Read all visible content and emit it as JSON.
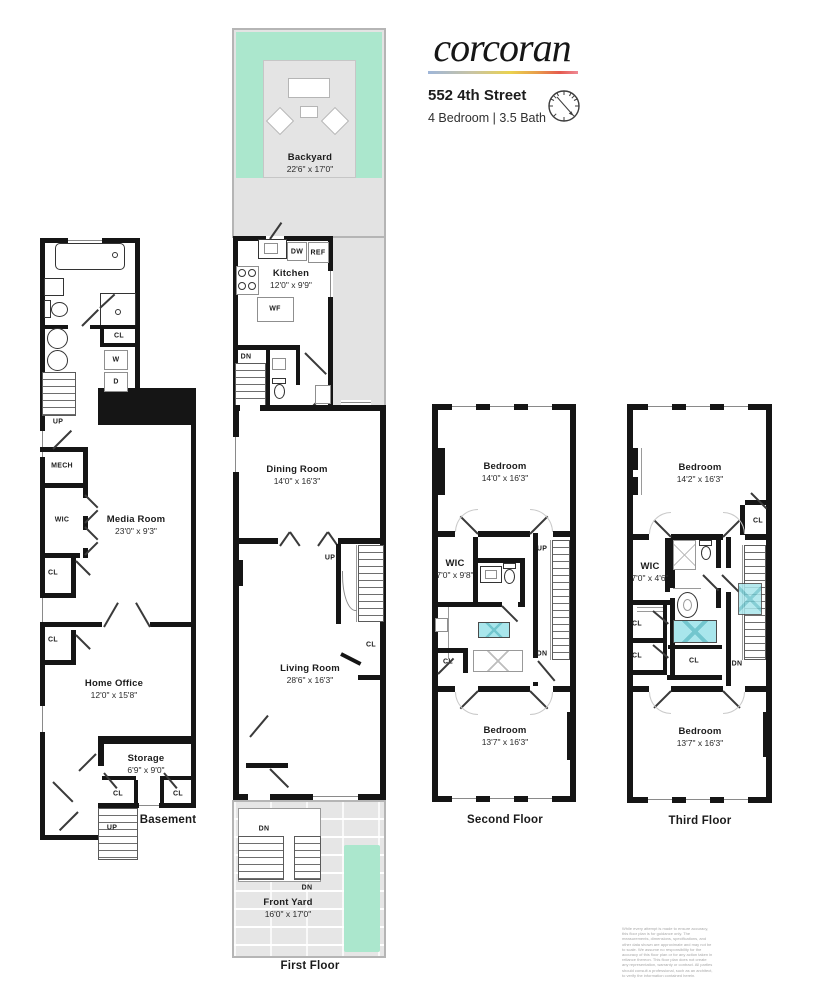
{
  "header": {
    "logo": "corcoran",
    "address": "552 4th Street",
    "specs": "4 Bedroom | 3.5 Bath"
  },
  "floor_labels": {
    "basement": "Basement",
    "first": "First Floor",
    "second": "Second Floor",
    "third": "Third Floor"
  },
  "rooms": {
    "backyard": {
      "name": "Backyard",
      "dims": "22'6\" x 17'0\""
    },
    "kitchen": {
      "name": "Kitchen",
      "dims": "12'0\" x 9'9\""
    },
    "dining": {
      "name": "Dining Room",
      "dims": "14'0\" x 16'3\""
    },
    "living": {
      "name": "Living Room",
      "dims": "28'6\" x 16'3\""
    },
    "front_yard": {
      "name": "Front Yard",
      "dims": "16'0\" x 17'0\""
    },
    "media": {
      "name": "Media Room",
      "dims": "23'0\" x 9'3\""
    },
    "home_office": {
      "name": "Home Office",
      "dims": "12'0\" x 15'8\""
    },
    "storage": {
      "name": "Storage",
      "dims": "6'9\" x 9'0\""
    },
    "bedroom2f": {
      "name": "Bedroom",
      "dims": "14'0\" x 16'3\""
    },
    "bedroom2b": {
      "name": "Bedroom",
      "dims": "13'7\" x 16'3\""
    },
    "bedroom3f": {
      "name": "Bedroom",
      "dims": "14'2\" x 16'3\""
    },
    "bedroom3b": {
      "name": "Bedroom",
      "dims": "13'7\" x 16'3\""
    },
    "wic2": {
      "name": "WIC",
      "dims": "7'0\" x 9'8\""
    },
    "wic3": {
      "name": "WIC",
      "dims": "7'0\" x 4'6\""
    }
  },
  "tags": {
    "cl": "CL",
    "up": "UP",
    "dn": "DN",
    "wic": "WIC",
    "mech": "MECH",
    "w": "W",
    "d": "D",
    "dw": "DW",
    "ref": "REF",
    "wf": "WF"
  },
  "disclaimer": "While every attempt is made to ensure accuracy, this floor plan is for guidance only. The measurements, dimensions, specifications, and other data shown are approximate and may not be to scale. We assume no responsibility for the accuracy of this floor plan or for any action taken in reliance thereon. This floor plan does not create any representation, warranty or contract. All parties should consult a professional, such as an architect, to verify the information contained herein."
}
